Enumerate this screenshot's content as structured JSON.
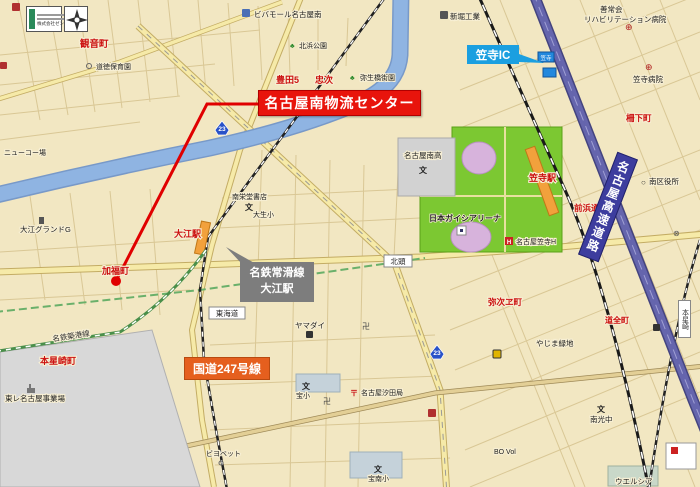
{
  "callouts": {
    "main_label": "名古屋南物流センター",
    "ic_label": "笠寺IC",
    "line_box_line1": "名鉄常滑線",
    "line_box_line2": "大江駅",
    "route_label": "国道247号線"
  },
  "stamp": {
    "company": "株式会社ゼンリン"
  },
  "roads": {
    "expressway": "名古屋高速道路",
    "route23": "23",
    "sign_kasadera": "笠寺",
    "jct_kitagashira": "北頭",
    "jct_tokaido": "東海道",
    "sta_honhoshizaki": "本星崎"
  },
  "places": {
    "kannoncho": "観音町",
    "dotoku_nursery": "道徳保育園",
    "viva_mall": "ビバモール名古屋南",
    "shinbori": "新堀工業",
    "kitahama_park": "北浜公園",
    "toyota5": "豊田5",
    "chuji": "忠次",
    "yayoibashi_park": "弥生橋街園",
    "zenjokai1": "善常会",
    "zenjokai2": "リハビリテーション病院",
    "kasadera_hospital": "笠寺病院",
    "sakushita": "柵下町",
    "minami_high": "名古屋南高",
    "kasadera_station": "笠寺駅",
    "ward_office": "南区役所",
    "maehama": "前浜通",
    "gaishi_arena": "日本ガイシアリーナ",
    "kasadera_hotel": "名古屋笠寺H",
    "oe_station": "大江駅",
    "nanei_books": "南栄堂書店",
    "taisei_elem": "大生小",
    "oe_ground": "大江グランドG",
    "kafuku": "加福町",
    "newcopo": "ニューコー場",
    "chikko_line": "名鉄築港線",
    "honhoshizaki_cho": "本星崎町",
    "toray": "東レ名古屋事業場",
    "yamadai": "ヤマダイ",
    "yajie": "弥次ヱ町",
    "yajima_green": "やじま緑地",
    "dozencho": "道全町",
    "shioda_post": "名古屋汐田局",
    "takara_elem": "宝小",
    "takara_minami_elem": "宝南小",
    "biyobetto": "ビヨベット",
    "nanko_jhs": "南光中",
    "welcia": "ウエルシア",
    "bovol": "BO Vol"
  },
  "icons": {
    "school": "文",
    "temple": "卍",
    "post": "〒",
    "hospital": "⊕",
    "tree": "♣",
    "office": "○",
    "cross_circle": "⊗",
    "hotel": "H"
  },
  "colors": {
    "banner_red": "#e8140c",
    "ic_blue": "#1b9fe0",
    "gray_box": "#7d7d7d",
    "route_orange": "#e55f1e",
    "expressway_blue": "#3d3d9e",
    "park_green": "#7cc832",
    "river_blue": "#8fb4e2",
    "station_orange": "#f2a13c"
  }
}
